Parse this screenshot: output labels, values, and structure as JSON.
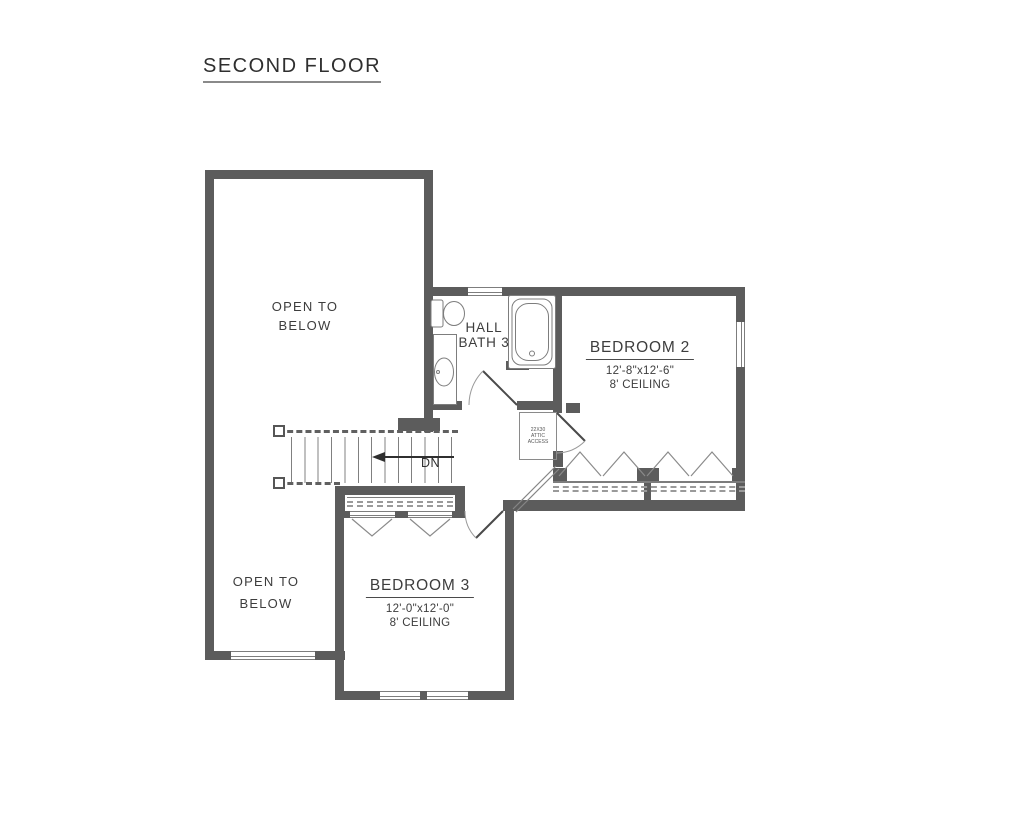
{
  "title": "SECOND FLOOR",
  "rooms": {
    "open_below_upper": {
      "line1": "OPEN TO",
      "line2": "BELOW"
    },
    "open_below_lower": {
      "line1": "OPEN TO",
      "line2": "BELOW"
    },
    "hall_bath": {
      "line1": "HALL",
      "line2": "BATH 3"
    },
    "bedroom2": {
      "name": "BEDROOM 2",
      "dimensions": "12'-8\"x12'-6\"",
      "ceiling": "8' CEILING"
    },
    "bedroom3": {
      "name": "BEDROOM 3",
      "dimensions": "12'-0\"x12'-0\"",
      "ceiling": "8' CEILING"
    }
  },
  "stairs": {
    "direction_label": "DN"
  },
  "attic_access": {
    "line1": "22X30",
    "line2": "ATTIC",
    "line3": "ACCESS"
  },
  "fixtures": {
    "toilet": "toilet",
    "vanity": "vanity-sink",
    "tub": "bathtub"
  },
  "colors": {
    "wall": "#5c5c5c",
    "thin_line": "#7d7d7d",
    "text": "#3d3d3d",
    "background": "#ffffff"
  }
}
